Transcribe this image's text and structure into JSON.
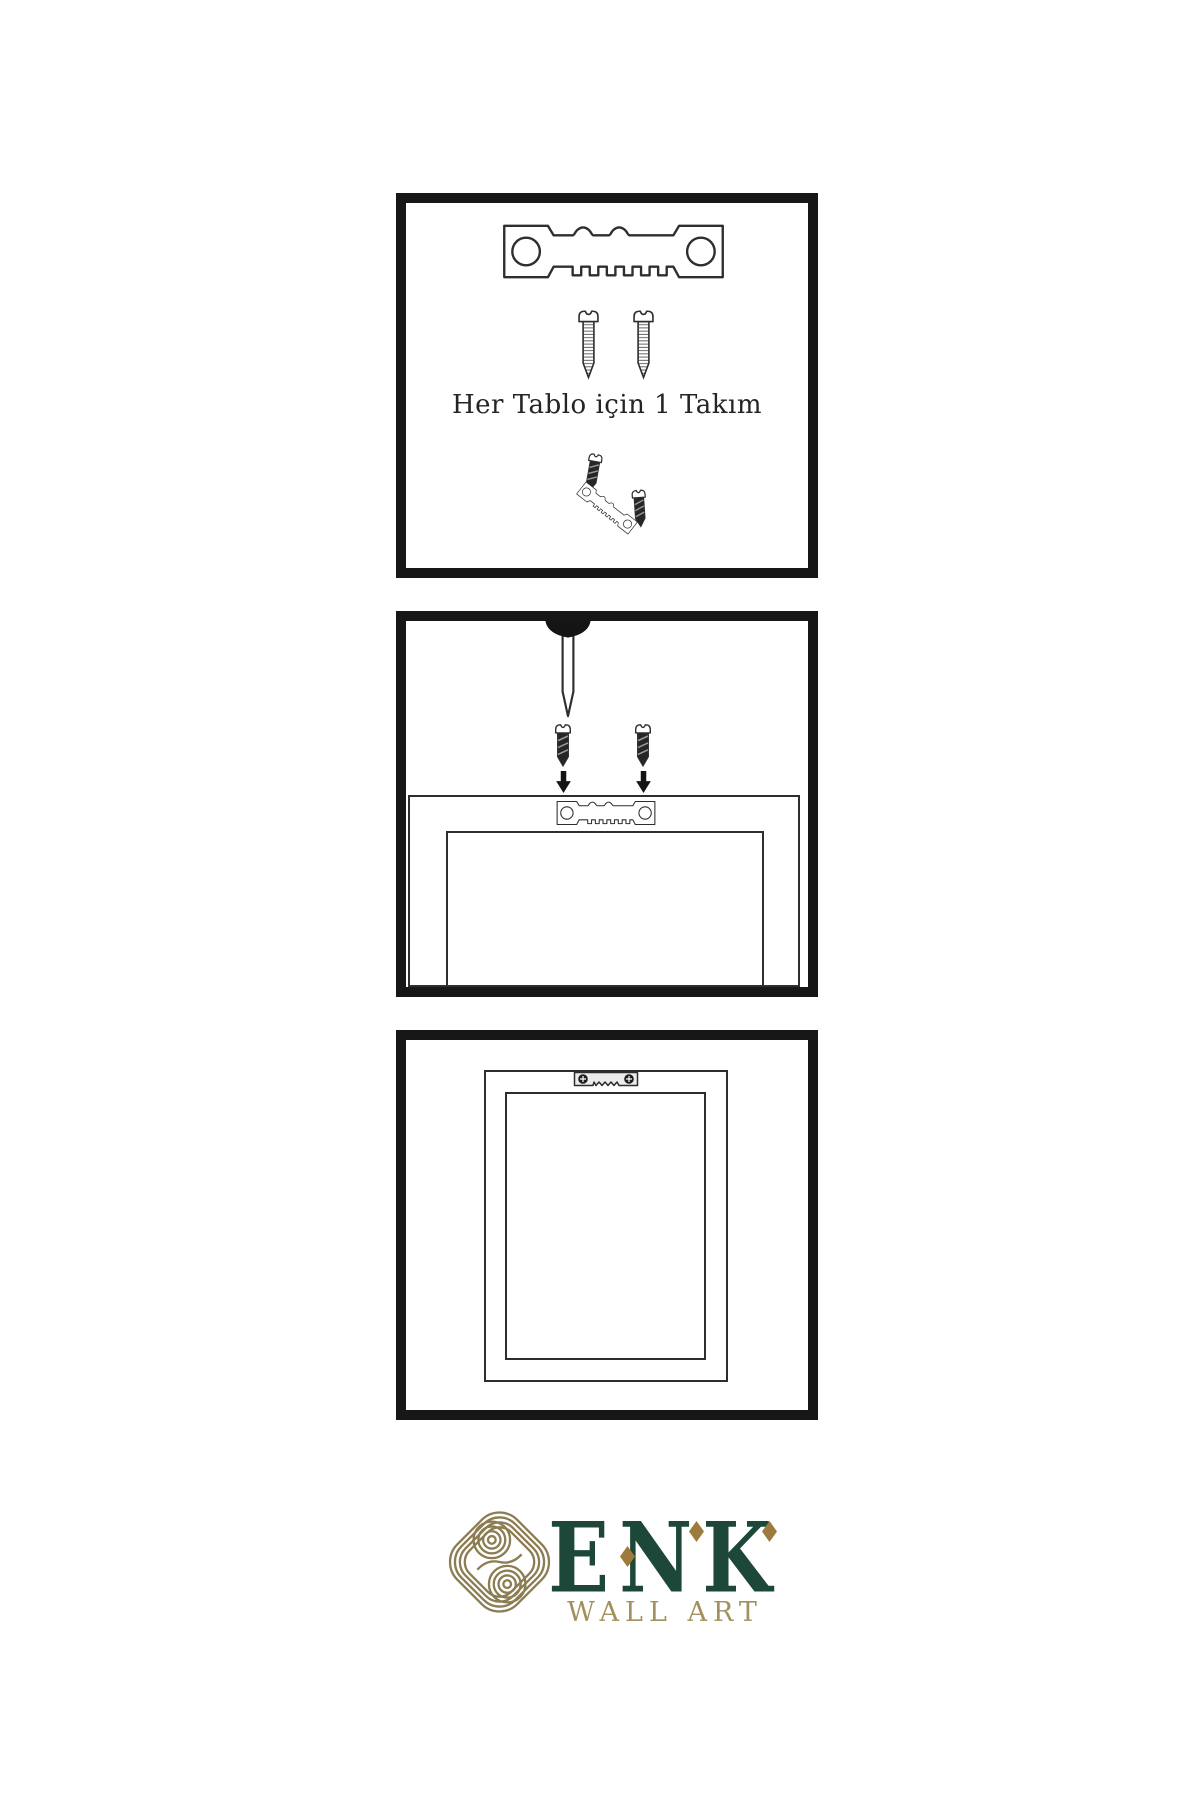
{
  "colors": {
    "panel_border": "#171717",
    "line": "#2e2e2e",
    "dark": "#262626",
    "caption": "#242424",
    "brand_green": "#1d4839",
    "brand_gold": "#9c7b3c",
    "brand_tan": "#a3905e",
    "knot": "#8b7c52"
  },
  "panels": {
    "step1": {
      "caption": "Her Tablo için 1 Takım",
      "icons": [
        "sawtooth-hanger",
        "mounting-screw",
        "mounting-screw",
        "hanger-kit-angled"
      ]
    },
    "step2": {
      "icons": [
        "wall-nail",
        "mounting-screw-down",
        "down-arrow",
        "mounting-screw-down",
        "down-arrow",
        "frame-back-outline",
        "sawtooth-hanger"
      ]
    },
    "step3": {
      "icons": [
        "frame-back-outline",
        "mounted-sawtooth-hanger"
      ]
    }
  },
  "logo": {
    "brand": "ENK",
    "subtitle": "WALL ART",
    "emblem": "interlaced-knot"
  }
}
